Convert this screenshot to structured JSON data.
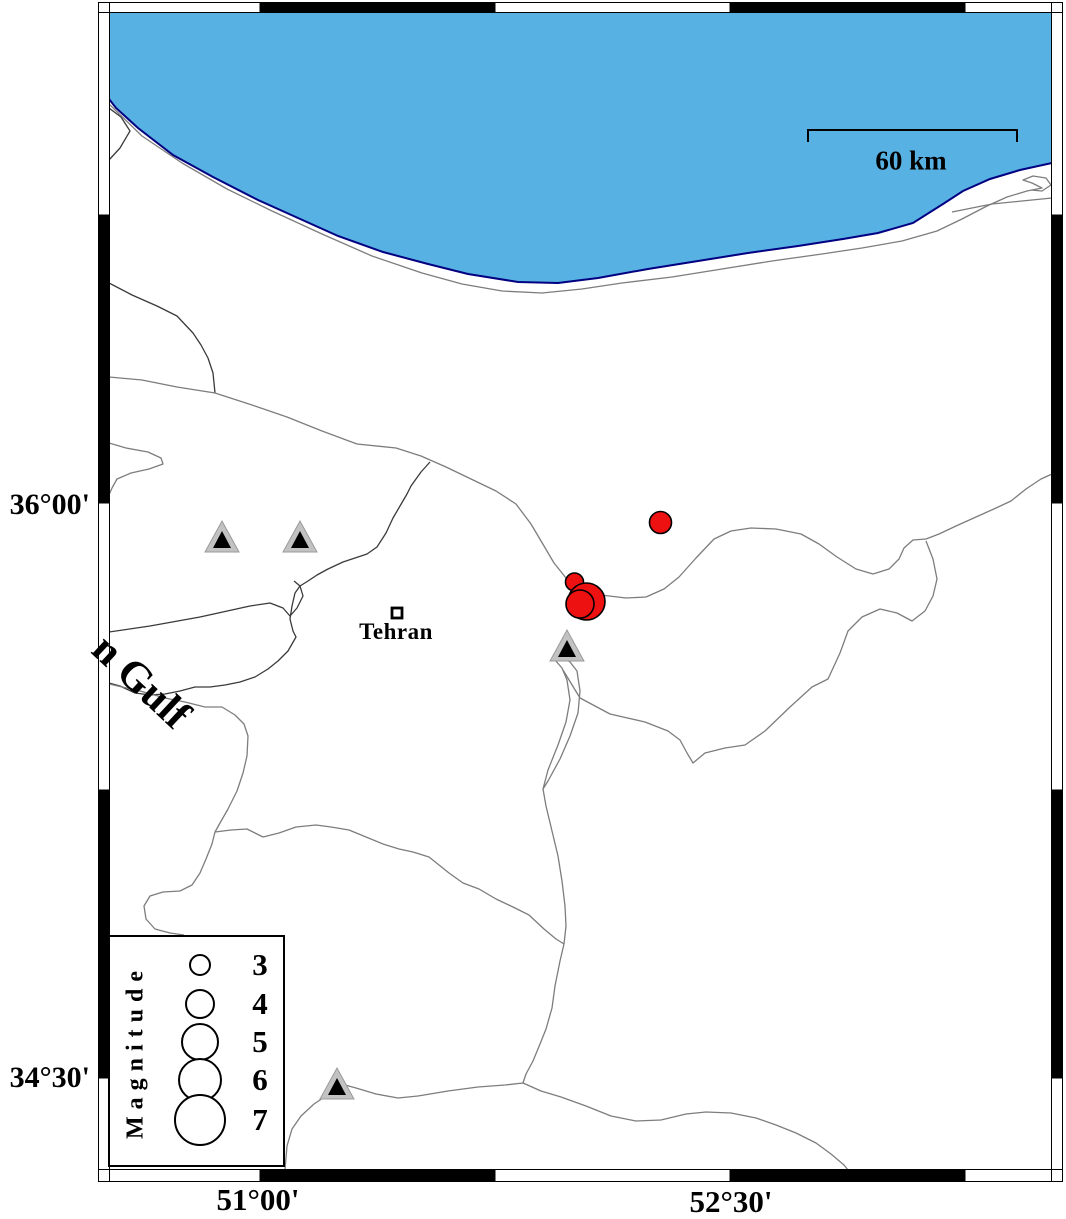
{
  "frame": {
    "lat_labels": [
      {
        "text": "36°00'",
        "y": 505
      },
      {
        "text": "34°30'",
        "y": 1078
      }
    ],
    "lon_labels": [
      {
        "text": "51°00'",
        "x": 258
      },
      {
        "text": "52°30'",
        "x": 731
      }
    ],
    "x_ticks": [
      260,
      495,
      730,
      965
    ],
    "y_ticks": [
      215,
      503,
      790,
      1078
    ]
  },
  "scalebar": {
    "label": "60 km",
    "x1": 808,
    "x2": 1017,
    "y": 130
  },
  "sea_label": {
    "text": "n Gulf",
    "rotation_deg": 43
  },
  "city": {
    "name": "Tehran",
    "x": 397,
    "y": 613
  },
  "legend": {
    "title": "Magnitude",
    "entries": [
      {
        "magnitude": "3",
        "r": 11
      },
      {
        "magnitude": "4",
        "r": 15
      },
      {
        "magnitude": "5",
        "r": 19
      },
      {
        "magnitude": "6",
        "r": 22
      },
      {
        "magnitude": "7",
        "r": 26
      }
    ]
  },
  "earthquakes": [
    {
      "x": 660.5,
      "y": 522.5,
      "r": 11,
      "approx_magnitude": 3.0
    },
    {
      "x": 574.5,
      "y": 582,
      "r": 9,
      "approx_magnitude": 2.5
    },
    {
      "x": 586.5,
      "y": 601.5,
      "r": 18.5,
      "approx_magnitude": 4.9
    },
    {
      "x": 580,
      "y": 604,
      "r": 14,
      "approx_magnitude": 3.8
    }
  ],
  "volcanoes": [
    {
      "x": 222,
      "y": 537
    },
    {
      "x": 300,
      "y": 537
    },
    {
      "x": 567,
      "y": 646
    },
    {
      "x": 337,
      "y": 1084
    }
  ],
  "colors": {
    "sea": "#57B1E2",
    "coastline": "#000080",
    "road": "#7d7d7d",
    "boundary": "#3a3a3a",
    "earthquake_fill": "#EE1111",
    "volcano_fill": "#C2C2C2",
    "volcano_edge": "#9a9a9a",
    "volcano_inner": "#000000"
  },
  "geometry": {
    "sea_polygon": [
      [
        109,
        12
      ],
      [
        1052,
        12
      ],
      [
        1052,
        163
      ],
      [
        1020,
        170
      ],
      [
        990,
        179
      ],
      [
        963,
        191
      ],
      [
        943,
        204
      ],
      [
        913,
        223
      ],
      [
        878,
        233
      ],
      [
        843,
        239
      ],
      [
        798,
        246
      ],
      [
        748,
        253
      ],
      [
        698,
        261
      ],
      [
        648,
        269
      ],
      [
        598,
        278
      ],
      [
        558,
        283
      ],
      [
        518,
        282
      ],
      [
        468,
        274
      ],
      [
        428,
        264
      ],
      [
        383,
        252
      ],
      [
        338,
        236
      ],
      [
        298,
        218
      ],
      [
        258,
        200
      ],
      [
        213,
        177
      ],
      [
        173,
        155
      ],
      [
        138,
        128
      ],
      [
        116,
        108
      ],
      [
        109,
        99
      ]
    ],
    "coastline": [
      [
        109,
        99
      ],
      [
        116,
        108
      ],
      [
        138,
        128
      ],
      [
        173,
        155
      ],
      [
        213,
        177
      ],
      [
        258,
        200
      ],
      [
        298,
        218
      ],
      [
        338,
        236
      ],
      [
        383,
        252
      ],
      [
        428,
        264
      ],
      [
        468,
        274
      ],
      [
        518,
        282
      ],
      [
        558,
        283
      ],
      [
        598,
        278
      ],
      [
        648,
        269
      ],
      [
        698,
        261
      ],
      [
        748,
        253
      ],
      [
        798,
        246
      ],
      [
        843,
        239
      ],
      [
        878,
        233
      ],
      [
        913,
        223
      ],
      [
        943,
        204
      ],
      [
        963,
        191
      ],
      [
        990,
        179
      ],
      [
        1020,
        170
      ],
      [
        1052,
        163
      ]
    ],
    "roads": [
      [
        [
          109,
          104
        ],
        [
          142,
          136
        ],
        [
          182,
          163
        ],
        [
          227,
          189
        ],
        [
          272,
          211
        ],
        [
          322,
          234
        ],
        [
          372,
          256
        ],
        [
          422,
          273
        ],
        [
          462,
          284
        ],
        [
          502,
          291
        ],
        [
          542,
          293
        ],
        [
          582,
          289
        ],
        [
          622,
          283
        ],
        [
          672,
          277
        ],
        [
          722,
          269
        ],
        [
          772,
          261
        ],
        [
          822,
          254
        ],
        [
          862,
          248
        ],
        [
          902,
          241
        ],
        [
          937,
          231
        ],
        [
          962,
          219
        ],
        [
          987,
          206
        ],
        [
          1007,
          197
        ],
        [
          1027,
          191
        ],
        [
          1042,
          188
        ],
        [
          1032,
          183
        ],
        [
          1023,
          180
        ],
        [
          1033,
          176
        ],
        [
          1046,
          178
        ],
        [
          1051,
          185
        ],
        [
          1042,
          191
        ],
        [
          1031,
          190
        ]
      ],
      [
        [
          952,
          212
        ],
        [
          992,
          204
        ],
        [
          1022,
          201
        ],
        [
          1052,
          198
        ]
      ],
      [
        [
          109,
          443
        ],
        [
          126,
          448
        ],
        [
          148,
          452
        ],
        [
          161,
          458
        ],
        [
          163,
          464
        ],
        [
          149,
          469
        ],
        [
          131,
          473
        ],
        [
          117,
          479
        ],
        [
          112,
          488
        ],
        [
          109,
          495
        ]
      ],
      [
        [
          109,
          377
        ],
        [
          142,
          380
        ],
        [
          177,
          387
        ],
        [
          215,
          393
        ],
        [
          252,
          405
        ],
        [
          287,
          417
        ],
        [
          322,
          431
        ],
        [
          357,
          444
        ],
        [
          396,
          448
        ],
        [
          421,
          456
        ],
        [
          446,
          467
        ],
        [
          471,
          479
        ],
        [
          496,
          491
        ],
        [
          516,
          504
        ],
        [
          531,
          524
        ],
        [
          544,
          546
        ],
        [
          554,
          563
        ],
        [
          566,
          578
        ],
        [
          581,
          589
        ],
        [
          601,
          595
        ],
        [
          626,
          598
        ],
        [
          646,
          597
        ],
        [
          664,
          589
        ],
        [
          679,
          577
        ],
        [
          696,
          558
        ],
        [
          714,
          539
        ],
        [
          731,
          531
        ],
        [
          751,
          528
        ],
        [
          776,
          529
        ],
        [
          801,
          534
        ],
        [
          819,
          544
        ],
        [
          837,
          557
        ],
        [
          856,
          569
        ],
        [
          873,
          574
        ],
        [
          889,
          569
        ],
        [
          899,
          559
        ],
        [
          904,
          548
        ],
        [
          913,
          540
        ],
        [
          926,
          539
        ],
        [
          939,
          534
        ],
        [
          956,
          526
        ],
        [
          976,
          517
        ],
        [
          996,
          508
        ],
        [
          1011,
          501
        ],
        [
          1026,
          489
        ],
        [
          1041,
          479
        ],
        [
          1052,
          474
        ]
      ],
      [
        [
          563,
          670
        ],
        [
          580,
          698
        ],
        [
          610,
          714
        ],
        [
          645,
          722
        ],
        [
          668,
          731
        ],
        [
          680,
          740
        ],
        [
          687,
          753
        ],
        [
          693,
          763
        ],
        [
          705,
          753
        ],
        [
          725,
          748
        ],
        [
          745,
          745
        ],
        [
          765,
          731
        ],
        [
          790,
          707
        ],
        [
          812,
          687
        ],
        [
          828,
          679
        ],
        [
          840,
          653
        ],
        [
          848,
          631
        ],
        [
          862,
          617
        ],
        [
          880,
          609
        ],
        [
          897,
          613
        ],
        [
          912,
          621
        ],
        [
          925,
          611
        ],
        [
          933,
          596
        ],
        [
          937,
          579
        ],
        [
          933,
          559
        ],
        [
          926,
          541
        ]
      ],
      [
        [
          555,
          660
        ],
        [
          562,
          668
        ],
        [
          567,
          680
        ],
        [
          570,
          700
        ],
        [
          566,
          722
        ],
        [
          558,
          745
        ],
        [
          548,
          770
        ],
        [
          543,
          789
        ],
        [
          548,
          781
        ],
        [
          560,
          759
        ],
        [
          570,
          736
        ],
        [
          578,
          713
        ],
        [
          580,
          691
        ],
        [
          577,
          671
        ],
        [
          570,
          662
        ],
        [
          562,
          657
        ],
        [
          555,
          660
        ]
      ],
      [
        [
          543,
          789
        ],
        [
          546,
          806
        ],
        [
          552,
          831
        ],
        [
          558,
          856
        ],
        [
          562,
          881
        ],
        [
          565,
          906
        ],
        [
          566,
          926
        ],
        [
          564,
          944
        ],
        [
          560,
          961
        ],
        [
          555,
          986
        ],
        [
          552,
          1008
        ],
        [
          546,
          1029
        ],
        [
          540,
          1044
        ],
        [
          533,
          1061
        ],
        [
          526,
          1074
        ],
        [
          523,
          1083
        ]
      ],
      [
        [
          523,
          1083
        ],
        [
          505,
          1085
        ],
        [
          478,
          1087
        ],
        [
          448,
          1091
        ],
        [
          418,
          1096
        ],
        [
          398,
          1098
        ],
        [
          376,
          1094
        ],
        [
          356,
          1088
        ],
        [
          345,
          1085
        ],
        [
          329,
          1094
        ],
        [
          314,
          1104
        ],
        [
          301,
          1116
        ],
        [
          292,
          1129
        ],
        [
          287,
          1146
        ],
        [
          285,
          1170
        ]
      ],
      [
        [
          523,
          1083
        ],
        [
          541,
          1091
        ],
        [
          561,
          1097
        ],
        [
          586,
          1106
        ],
        [
          611,
          1116
        ],
        [
          636,
          1121
        ],
        [
          661,
          1120
        ],
        [
          686,
          1114
        ],
        [
          706,
          1112
        ],
        [
          731,
          1113
        ],
        [
          756,
          1118
        ],
        [
          776,
          1125
        ],
        [
          796,
          1133
        ],
        [
          816,
          1143
        ],
        [
          831,
          1154
        ],
        [
          844,
          1165
        ],
        [
          848,
          1170
        ]
      ],
      [
        [
          215,
          832
        ],
        [
          231,
          830
        ],
        [
          247,
          829
        ],
        [
          263,
          837
        ],
        [
          279,
          833
        ],
        [
          296,
          827
        ],
        [
          316,
          825
        ],
        [
          331,
          827
        ],
        [
          349,
          830
        ],
        [
          366,
          837
        ],
        [
          383,
          844
        ],
        [
          399,
          849
        ],
        [
          413,
          852
        ],
        [
          429,
          857
        ],
        [
          439,
          865
        ],
        [
          449,
          873
        ],
        [
          463,
          883
        ],
        [
          479,
          889
        ],
        [
          496,
          899
        ],
        [
          513,
          907
        ],
        [
          529,
          915
        ],
        [
          544,
          929
        ],
        [
          556,
          939
        ],
        [
          564,
          944
        ]
      ],
      [
        [
          109,
          684
        ],
        [
          140,
          691
        ],
        [
          165,
          698
        ],
        [
          185,
          702
        ],
        [
          205,
          707
        ],
        [
          222,
          707
        ],
        [
          235,
          715
        ],
        [
          244,
          724
        ],
        [
          248,
          736
        ],
        [
          247,
          756
        ],
        [
          243,
          773
        ],
        [
          237,
          791
        ],
        [
          228,
          809
        ],
        [
          220,
          823
        ],
        [
          215,
          832
        ],
        [
          212,
          844
        ],
        [
          206,
          859
        ],
        [
          200,
          873
        ],
        [
          192,
          885
        ],
        [
          180,
          891
        ],
        [
          163,
          892
        ],
        [
          150,
          896
        ],
        [
          144,
          906
        ],
        [
          146,
          919
        ],
        [
          155,
          929
        ],
        [
          170,
          933
        ],
        [
          184,
          935
        ]
      ]
    ],
    "boundaries": [
      [
        [
          109,
          108
        ],
        [
          121,
          117
        ],
        [
          130,
          131
        ],
        [
          120,
          148
        ],
        [
          109,
          160
        ]
      ],
      [
        [
          109,
          283
        ],
        [
          132,
          295
        ],
        [
          157,
          306
        ],
        [
          177,
          316
        ],
        [
          193,
          333
        ],
        [
          201,
          345
        ],
        [
          208,
          358
        ],
        [
          213,
          373
        ],
        [
          215,
          393
        ]
      ],
      [
        [
          109,
          632
        ],
        [
          150,
          626
        ],
        [
          200,
          617
        ],
        [
          250,
          606
        ],
        [
          270,
          603
        ],
        [
          283,
          608
        ],
        [
          290,
          616
        ],
        [
          297,
          608
        ],
        [
          303,
          596
        ],
        [
          300,
          586
        ],
        [
          294,
          581
        ]
      ],
      [
        [
          430,
          462
        ],
        [
          421,
          472
        ],
        [
          411,
          486
        ],
        [
          407,
          494
        ],
        [
          400,
          506
        ],
        [
          393,
          518
        ],
        [
          386,
          533
        ],
        [
          377,
          547
        ],
        [
          367,
          554
        ],
        [
          352,
          559
        ],
        [
          343,
          562
        ],
        [
          328,
          569
        ],
        [
          317,
          575
        ],
        [
          308,
          581
        ],
        [
          300,
          586
        ],
        [
          295,
          593
        ],
        [
          292,
          606
        ],
        [
          290,
          619
        ],
        [
          293,
          631
        ],
        [
          296,
          637
        ],
        [
          288,
          651
        ],
        [
          278,
          661
        ],
        [
          268,
          669
        ],
        [
          255,
          677
        ],
        [
          240,
          682
        ],
        [
          225,
          685
        ],
        [
          210,
          687
        ],
        [
          195,
          687
        ],
        [
          180,
          691
        ],
        [
          165,
          694
        ],
        [
          150,
          695
        ],
        [
          135,
          693
        ],
        [
          120,
          686
        ],
        [
          109,
          683
        ]
      ]
    ]
  }
}
